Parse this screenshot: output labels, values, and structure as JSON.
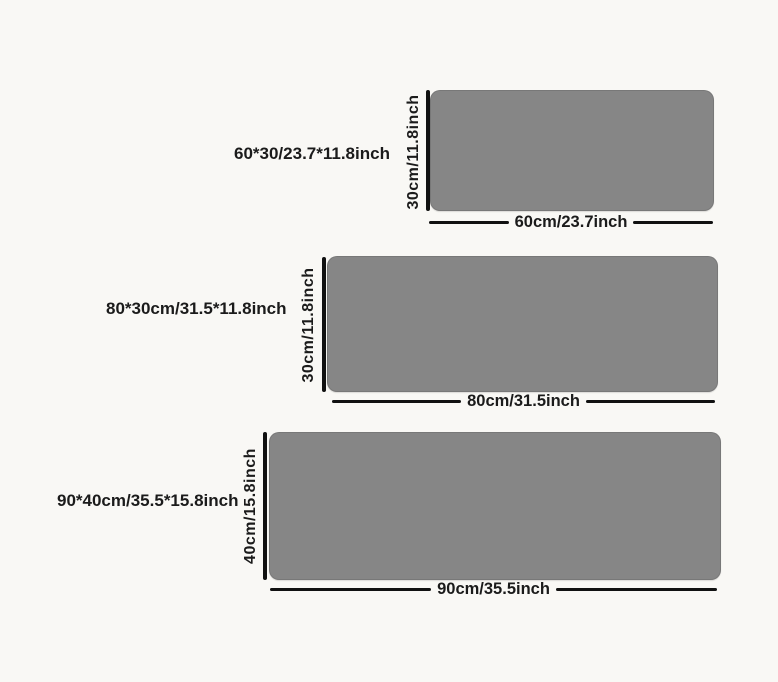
{
  "colors": {
    "background": "#f9f8f5",
    "mat_fill": "#868686",
    "line": "#111111",
    "text": "#1b1b1b"
  },
  "sizes": [
    {
      "name": "60x30",
      "label": "60*30/23.7*11.8inch",
      "height_label": "30cm/11.8inch",
      "width_label": "60cm/23.7inch"
    },
    {
      "name": "80x30",
      "label": "80*30cm/31.5*11.8inch",
      "height_label": "30cm/11.8inch",
      "width_label": "80cm/31.5inch"
    },
    {
      "name": "90x40",
      "label": "90*40cm/35.5*15.8inch",
      "height_label": "40cm/15.8inch",
      "width_label": "90cm/35.5inch"
    }
  ]
}
